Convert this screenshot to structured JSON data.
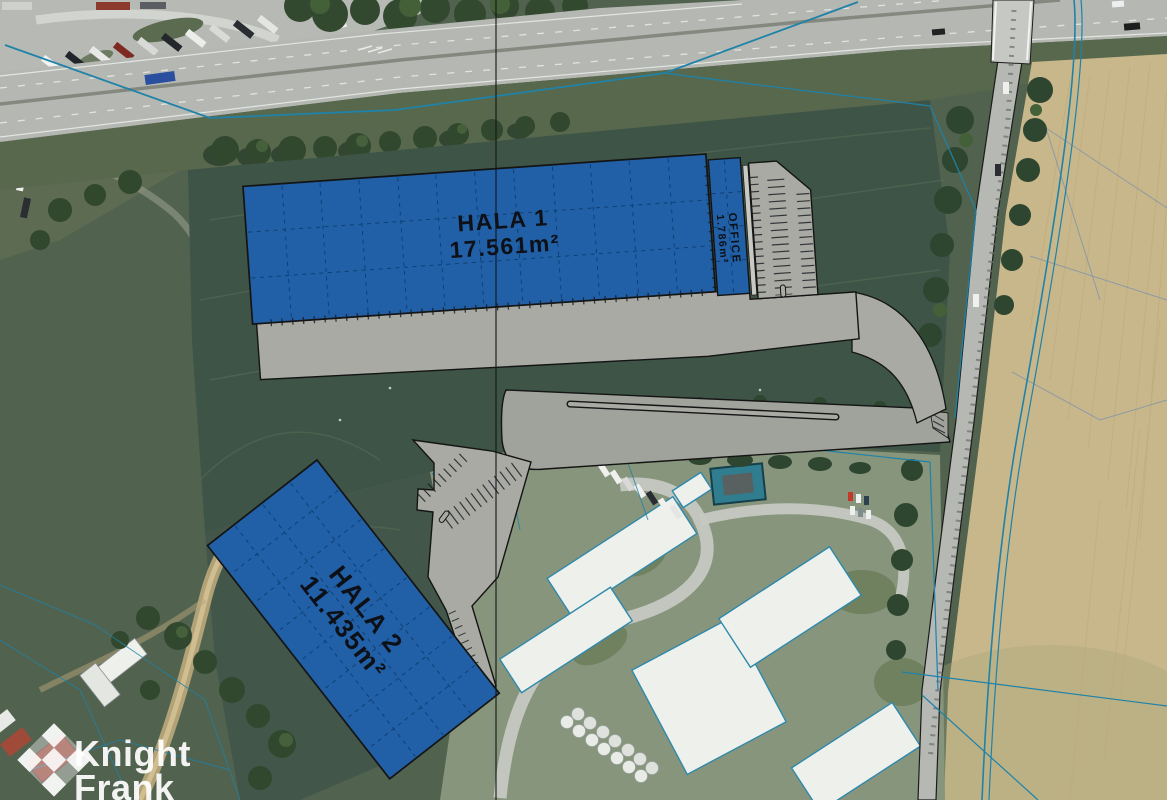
{
  "map": {
    "kind": "industrial park site plan over aerial photo",
    "buildings": [
      {
        "id": "hala-1",
        "label": "HALA 1",
        "area": "17.561m²"
      },
      {
        "id": "office",
        "label": "OFFICE",
        "area": "1.786m²"
      },
      {
        "id": "hala-2",
        "label": "HALA 2",
        "area": "11.435m²"
      }
    ],
    "colors": {
      "building_fill": "#2160a6",
      "building_grid": "#0c3c70",
      "paving_gray": "#a8aaa3",
      "plan_outline": "#141414",
      "cadastral_blue": "#1f82a8",
      "field_green": "#3e5447",
      "farmland_tan": "#c9b78c",
      "highway_gray": "#b4b7b2"
    }
  },
  "branding": {
    "logo_icon": "knight-frank-diamond-logo",
    "logo_line1": "Knight",
    "logo_line2": "Frank"
  }
}
